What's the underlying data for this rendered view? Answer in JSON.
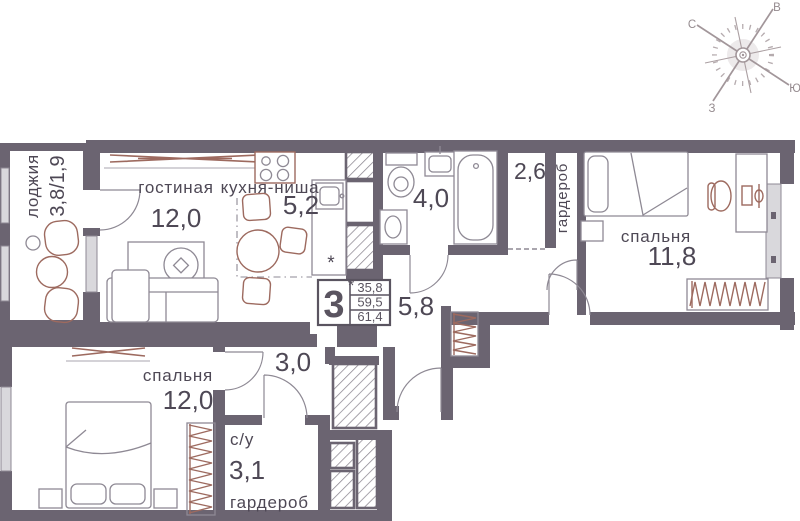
{
  "plan": {
    "type": "apartment-floorplan",
    "rooms_count": "3"
  },
  "info_box": {
    "rooms_count": "3",
    "note_mark": "*",
    "areas": [
      "35,8",
      "59,5",
      "61,4"
    ]
  },
  "compass": {
    "north": "С",
    "east": "В",
    "south": "Ю",
    "west": "З"
  },
  "rooms": {
    "loggia": {
      "label": "лоджия",
      "area": "3,8/1,9"
    },
    "living": {
      "label": "гостиная",
      "area": "12,0"
    },
    "kitchen": {
      "label": "кухня-ниша",
      "area": "5,2",
      "note_mark": "*"
    },
    "bathroom": {
      "area": "4,0"
    },
    "hall_upper": {
      "area": "2,6"
    },
    "wardrobe_upper": {
      "label": "гардероб"
    },
    "bedroom_right": {
      "label": "спальня",
      "area": "11,8"
    },
    "corridor": {
      "area": "5,8"
    },
    "hall_lower": {
      "area": "3,0"
    },
    "bedroom_left": {
      "label": "спальня",
      "area": "12,0"
    },
    "bathroom_small": {
      "label": "с/у",
      "area": "3,1"
    },
    "wardrobe_lower": {
      "label": "гардероб"
    }
  },
  "colors": {
    "wall": "#6b6471",
    "accent_brown": "#9d6a5f",
    "furniture_line": "#8e8994",
    "window_fill": "#d9d8dc",
    "text": "#4e4855"
  }
}
